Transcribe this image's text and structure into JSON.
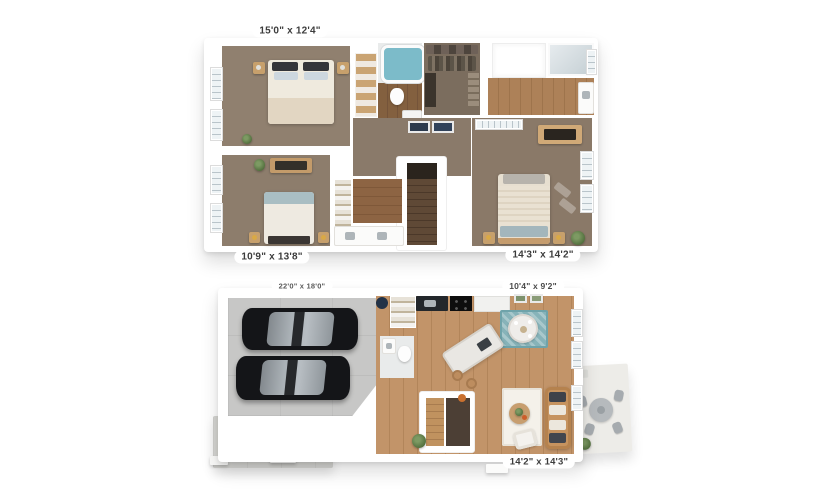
{
  "plans": {
    "upper": {
      "labels": {
        "bedroom1": "15'0\" x 12'4\"",
        "bedroom2": "10'9\" x 13'8\"",
        "master": "14'3\" x 14'2\""
      }
    },
    "lower": {
      "labels": {
        "garage": "22'0\" x 18'0\"",
        "kitchen": "10'4\" x 9'2\"",
        "living": "14'2\" x 14'3\""
      }
    }
  },
  "colors": {
    "background": "#ffffff",
    "carpet": "#8c7b6a",
    "hardwood_main": "#bd8f62",
    "hardwood_bath": "#7d5b40",
    "garage_concrete": "#c6c6c5",
    "driveway_concrete": "#d6d6d3",
    "patio_concrete": "#edece8",
    "tub_water": "#7cbbc9",
    "area_rug_teal": "#87b3b9",
    "sofa_tan": "#c6935f",
    "car_black": "#17181b"
  }
}
